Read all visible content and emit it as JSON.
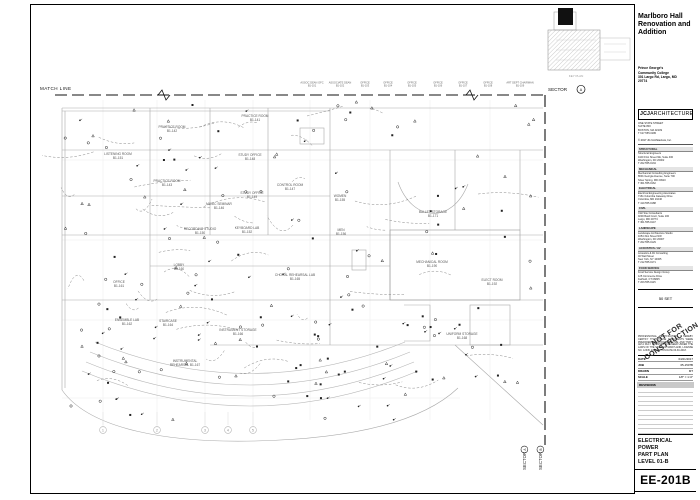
{
  "plan": {
    "match_line_label": "MATCH LINE",
    "keyplan_label": "KEY PLAN",
    "sector_top": {
      "label": "SECTOR",
      "letter": "A"
    },
    "sectors_bottom": [
      {
        "label": "SECTOR",
        "letter": "A"
      },
      {
        "label": "SECTOR",
        "letter": "B"
      }
    ],
    "grid_bubbles": [
      {
        "n": "1",
        "x": 103
      },
      {
        "n": "2",
        "x": 157
      },
      {
        "n": "3",
        "x": 205
      },
      {
        "n": "4",
        "x": 228
      },
      {
        "n": "5",
        "x": 253
      }
    ],
    "top_rooms": [
      {
        "name": "ASSOC DEAN OFC",
        "num": "B1-101",
        "x": 312
      },
      {
        "name": "ASSOCIATE DEAN",
        "num": "B1-102",
        "x": 340
      },
      {
        "name": "OFFICE",
        "num": "B1-103",
        "x": 365
      },
      {
        "name": "OFFICE",
        "num": "B1-104",
        "x": 388
      },
      {
        "name": "OFFICE",
        "num": "B1-105",
        "x": 412
      },
      {
        "name": "OFFICE",
        "num": "B1-106",
        "x": 438
      },
      {
        "name": "OFFICE",
        "num": "B1-107",
        "x": 463
      },
      {
        "name": "OFFICE",
        "num": "B1-108",
        "x": 488
      },
      {
        "name": "ART DEPT CHAIRMAN",
        "num": "B1-109",
        "x": 520
      }
    ],
    "rooms": [
      {
        "name": "PRACTICE ROOM",
        "num": "B1-141",
        "x": 255,
        "y": 117
      },
      {
        "name": "PRACTICE ROOM",
        "num": "B1-142",
        "x": 172,
        "y": 128
      },
      {
        "name": "LISTENING ROOM",
        "num": "B1-151",
        "x": 118,
        "y": 155
      },
      {
        "name": "PRACTICE ROOM",
        "num": "B1-143",
        "x": 167,
        "y": 182
      },
      {
        "name": "STUDY OFFICE",
        "num": "B1-148",
        "x": 250,
        "y": 156
      },
      {
        "name": "STUDY OFFICE",
        "num": "B1-149",
        "x": 252,
        "y": 194
      },
      {
        "name": "MUSIC SEMINAR",
        "num": "B1-146",
        "x": 219,
        "y": 205
      },
      {
        "name": "CONTROL ROOM",
        "num": "B1-147",
        "x": 290,
        "y": 186
      },
      {
        "name": "RECORDING STUDIO",
        "num": "B1-150",
        "x": 200,
        "y": 230
      },
      {
        "name": "KEYBOARD LAB",
        "num": "B1-152",
        "x": 247,
        "y": 229
      },
      {
        "name": "WOMEN",
        "num": "B1-155",
        "x": 340,
        "y": 197
      },
      {
        "name": "MEN",
        "num": "B1-156",
        "x": 341,
        "y": 231
      },
      {
        "name": "BALLET STORAGE",
        "num": "B1-171",
        "x": 433,
        "y": 213
      },
      {
        "name": "LOBBY",
        "num": "B1-160",
        "x": 179,
        "y": 266
      },
      {
        "name": "OFFICE",
        "num": "B1-161",
        "x": 119,
        "y": 283
      },
      {
        "name": "CHORAL REHEARSAL LAB",
        "num": "B1-165",
        "x": 295,
        "y": 276
      },
      {
        "name": "ENSEMBLE LAB",
        "num": "B1-162",
        "x": 127,
        "y": 321
      },
      {
        "name": "STAIRCASE",
        "num": "B1-164",
        "x": 168,
        "y": 322
      },
      {
        "name": "INSTRUMENT STORAGE",
        "num": "B1-166",
        "x": 238,
        "y": 331
      },
      {
        "name": "MECHANICAL ROOM",
        "num": "B1-190",
        "x": 432,
        "y": 263
      },
      {
        "name": "ELECT ROOM",
        "num": "B1-192",
        "x": 492,
        "y": 281
      },
      {
        "name": "UNIFORM STORAGE",
        "num": "B1-168",
        "x": 462,
        "y": 335
      },
      {
        "name": "INSTRUMENTAL",
        "num": "REHEARSAL  B1-167",
        "x": 185,
        "y": 362
      }
    ]
  },
  "titleblock": {
    "project_title": [
      "Marlboro Hall",
      "Renovation and",
      "Addition"
    ],
    "client": [
      "Prince George's",
      "Community College",
      "301 Largo Rd, Largo, MD",
      "20774"
    ],
    "firm": {
      "logo_bold": "JCJ",
      "logo_rest": "ARCHITECTURE",
      "address": [
        "ONE STATE STREET",
        "SUITE 800",
        "BOSTON, MA 02109",
        "T 617.555.0180"
      ],
      "copyright": "© 2017 JCJ Architecture, Inc."
    },
    "consultants": [
      {
        "h": "STRUCTURAL",
        "lines": [
          "Structural Engineers",
          "1100 First Street NE, Suite 400",
          "Washington, DC 20002",
          "T 202.555.0134"
        ]
      },
      {
        "h": "MECHANICAL",
        "lines": [
          "Mechanical Consulting Engineers",
          "8601 Georgia Avenue, Suite 700",
          "Silver Spring, MD 20910",
          "T 301.555.0162"
        ]
      },
      {
        "h": "ELECTRICAL",
        "lines": [
          "Electrical Engineering Associates",
          "7161 Columbia Gateway Drive",
          "Columbia, MD 21046",
          "T 410.555.0188"
        ]
      },
      {
        "h": "CIVIL",
        "lines": [
          "Civil Site Consultants",
          "9200 Basil Court, Suite 100",
          "Largo, MD 20774",
          "T 301.555.0147"
        ]
      },
      {
        "h": "LANDSCAPE",
        "lines": [
          "Landscape Architecture Studio",
          "1054 31st Street NW",
          "Washington, DC 20007",
          "T 202.555.0129"
        ]
      },
      {
        "h": "ACOUSTICS / AV",
        "lines": [
          "Acoustics & AV Consulting",
          "40 Wall Street",
          "New York, NY 10005",
          "T 212.555.0171"
        ]
      },
      {
        "h": "FOOD SERVICE",
        "lines": [
          "Food Service Design Group",
          "125 Commerce Drive",
          "Fairfield, CT 06825",
          "T 203.555.0115"
        ]
      }
    ],
    "set_label": "50 SET",
    "stamp_line1": "NOT FOR",
    "stamp_line2": "CONSTRUCTION",
    "certification": "PROFESSIONAL CERTIFICATION: I HEREBY CERTIFY THAT THESE DOCUMENTS WERE PREPARED OR APPROVED BY ME, AND THAT I AM A DULY LICENSED ENGINEER UNDER THE LAWS OF THE STATE OF MARYLAND, LICENSE NO. 12345, EXPIRATION DATE 06-30-2018.",
    "fields": [
      {
        "label": "DATE",
        "value": "04/21/2017"
      },
      {
        "label": "JOB",
        "value": "05-1507B"
      },
      {
        "label": "DRAWN",
        "value": "MT"
      },
      {
        "label": "SCALE",
        "value": "1/8\" = 1'-0\""
      }
    ],
    "revisions_label": "REVISIONS",
    "sheet_title": [
      "ELECTRICAL",
      "POWER",
      "PART PLAN",
      "LEVEL 01-B"
    ],
    "sheet_number": "EE-201B"
  }
}
